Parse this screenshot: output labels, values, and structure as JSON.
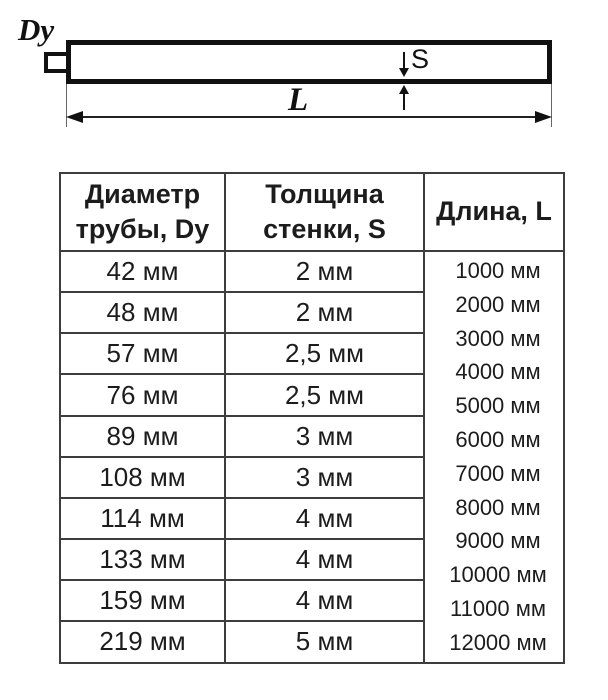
{
  "diagram": {
    "dy_label": "Dy",
    "s_label": "S",
    "l_label": "L"
  },
  "table": {
    "headers": {
      "diameter_line1": "Диаметр",
      "diameter_line2": "трубы, Dy",
      "thickness_line1": "Толщина",
      "thickness_line2": "стенки, S",
      "length": "Длина, L"
    },
    "rows": [
      {
        "diameter": "42 мм",
        "thickness": "2 мм"
      },
      {
        "diameter": "48 мм",
        "thickness": "2 мм"
      },
      {
        "diameter": "57 мм",
        "thickness": "2,5 мм"
      },
      {
        "diameter": "76 мм",
        "thickness": "2,5 мм"
      },
      {
        "diameter": "89 мм",
        "thickness": "3 мм"
      },
      {
        "diameter": "108 мм",
        "thickness": "3 мм"
      },
      {
        "diameter": "114 мм",
        "thickness": "4 мм"
      },
      {
        "diameter": "133 мм",
        "thickness": "4 мм"
      },
      {
        "diameter": "159 мм",
        "thickness": "4 мм"
      },
      {
        "diameter": "219 мм",
        "thickness": "5 мм"
      }
    ],
    "lengths": [
      "1000 мм",
      "2000 мм",
      "3000 мм",
      "4000 мм",
      "5000 мм",
      "6000 мм",
      "7000 мм",
      "8000 мм",
      "9000 мм",
      "10000 мм",
      "11000 мм",
      "12000 мм"
    ]
  },
  "colors": {
    "background": "#ffffff",
    "line": "#111111",
    "table_border": "#3d3d3d",
    "text": "#1c1c1c"
  }
}
